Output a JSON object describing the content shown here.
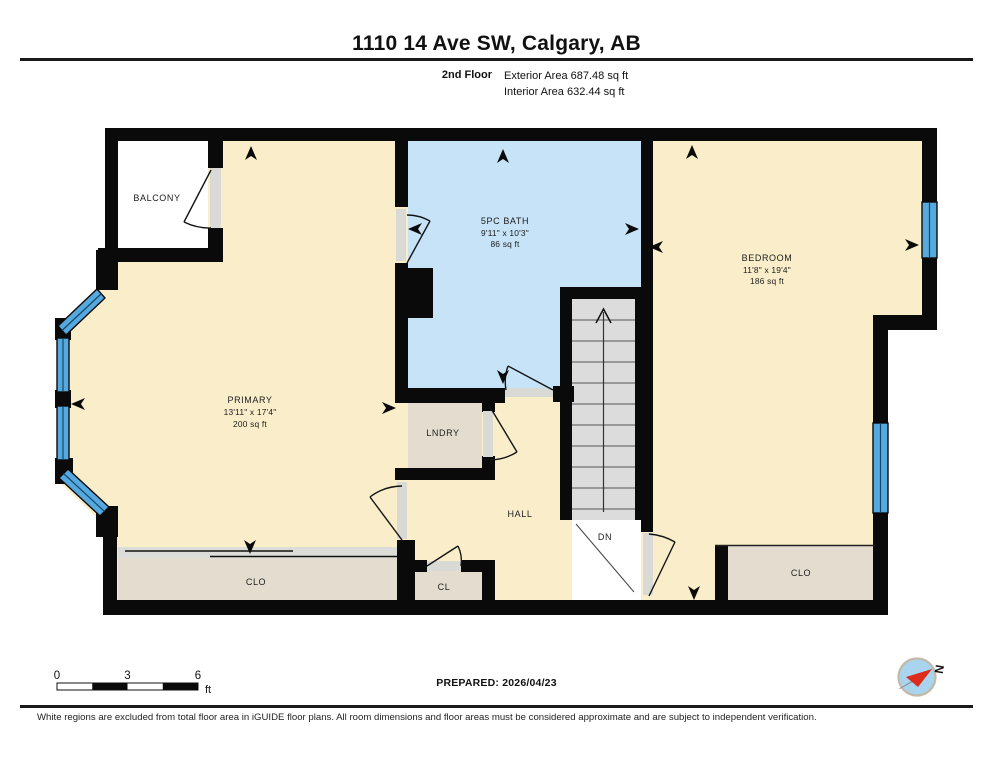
{
  "header": {
    "title": "1110 14 Ave SW, Calgary, AB",
    "floor_label": "2nd Floor",
    "exterior_area": "Exterior Area 687.48 sq ft",
    "interior_area": "Interior Area 632.44 sq ft"
  },
  "rooms": {
    "balcony": {
      "name": "BALCONY"
    },
    "primary": {
      "name": "PRIMARY",
      "dims": "13'11\" x 17'4\"",
      "area": "200 sq ft"
    },
    "bath": {
      "name": "5PC BATH",
      "dims": "9'11\" x 10'3\"",
      "area": "86 sq ft"
    },
    "bedroom": {
      "name": "BEDROOM",
      "dims": "11'8\" x 19'4\"",
      "area": "186 sq ft"
    },
    "laundry": {
      "name": "LNDRY"
    },
    "hall": {
      "name": "HALL"
    },
    "closet_primary": {
      "name": "CLO"
    },
    "closet_hall": {
      "name": "CL"
    },
    "closet_bedroom": {
      "name": "CLO"
    },
    "stairs_direction": {
      "name": "DN"
    }
  },
  "scale_bar": {
    "labels": [
      "0",
      "3",
      "6"
    ],
    "unit": "ft"
  },
  "prepared_label": "PREPARED: 2026/04/23",
  "compass": {
    "north_label": "N"
  },
  "footer": {
    "disclaimer": "White regions are excluded from total floor area in iGUIDE floor plans. All room dimensions and floor areas must be considered approximate and are subject to independent verification."
  },
  "colors": {
    "wall": "#0A0A0A",
    "floor": "#FAEDCA",
    "bath_floor": "#C6E3F7",
    "closet_floor": "#E4DDCF",
    "stairs": "#DCDCDC",
    "window": "#55A9DE",
    "compass_red": "#DD2B1C"
  }
}
